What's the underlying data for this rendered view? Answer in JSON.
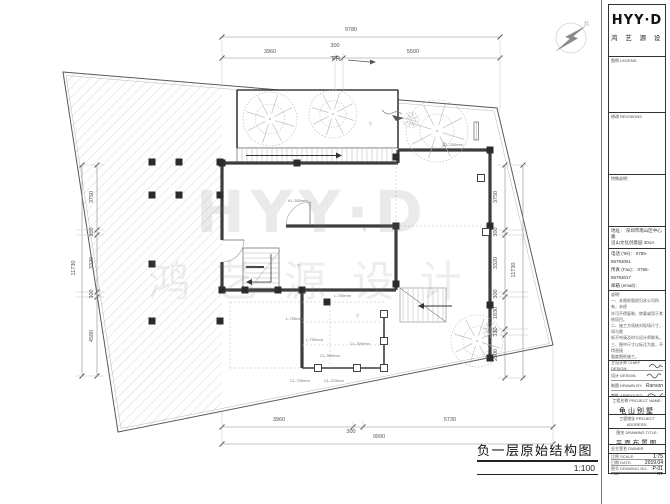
{
  "watermark": {
    "line1": "HYY·D",
    "line2": "鸿艺源设计"
  },
  "north_label": "北",
  "plan": {
    "title": "负一层原始结构图",
    "scale": "1:100",
    "ramp_label": "下R",
    "dims": {
      "top": {
        "overall": "9780",
        "segments": [
          "3960",
          "300",
          "5500"
        ]
      },
      "bottom": {
        "overall": "9990",
        "segments": [
          "3960",
          "300",
          "5730"
        ]
      },
      "left": {
        "overall": "11730",
        "segments": [
          "3750",
          "300",
          "3320",
          "300",
          "4580"
        ]
      },
      "right": {
        "overall": "11730",
        "segments": [
          "3750",
          "300",
          "3320",
          "300",
          "1830",
          "330",
          "2500"
        ]
      }
    },
    "beam_labels": [
      "KL-300mm",
      "梁L-300mm",
      "L-750mm",
      "L-700mm",
      "CL-300mm",
      "CL-350mm",
      "CL-700mm",
      "CL-470mm",
      "L-700mm",
      "▽",
      "▽",
      "▽",
      "▽"
    ]
  },
  "titleblock": {
    "logo": "HYY·D",
    "logo_sub": "鸿 艺 源 设 计",
    "legend_label": "图例 LEGEND",
    "revisions_label": "修改 REVISIONS",
    "special_label": "特殊说明：",
    "address1": "地址： 深圳市南山区中心路",
    "address2": "沿山文化创意园 301A",
    "contact": [
      "电话 (Tel)： 0755-86793061",
      "传真 (Fax)： 0755-86793017",
      "邮箱 (email)： shenzhenhyyd@163.com",
      "网址 (Web)： www.hyyd3.com"
    ],
    "notes_title": "说明：",
    "notes": [
      "一、本图纸版权归本公司所有，未经",
      "许可不得复制、转载或用于其他项目。",
      "二、施工方须核对现场尺寸，如与图",
      "纸不符请及时与设计师联系。",
      "三、图中尺寸以标注为准，不得直接",
      "量度图纸施工。",
      "四、水电及设备安装须符合国家相关",
      "规范要求。",
      "五、未尽事宜双方协商解决。"
    ],
    "signatures": [
      {
        "label": "主设计师 CHIEF DESIGN:",
        "value": ""
      },
      {
        "label": "设计 DESIGN:",
        "value": ""
      },
      {
        "label": "制图 DRAWN BY:",
        "value": "Ranson"
      },
      {
        "label": "审批 APPROVED:",
        "value": ""
      }
    ],
    "project_name_label": "工程名称 PROJECT NAME:",
    "project_name": "龟山别墅",
    "project_addr_label": "工程地址 PROJECT ADDRESS:",
    "project_addr": "深圳",
    "drawing_title_label": "图名 DRAWING TITLE:",
    "drawing_title": "平面布置图",
    "owner_label": "业主签名 OWNER SIGNATURE:",
    "meta": [
      {
        "label": "比例 SCALE:",
        "value": "1:75"
      },
      {
        "label": "日期 DATE:",
        "value": "2019.04"
      },
      {
        "label": "图号 DRAWING NO:",
        "value": "P-01"
      },
      {
        "label": "页码",
        "value": "01"
      }
    ]
  }
}
